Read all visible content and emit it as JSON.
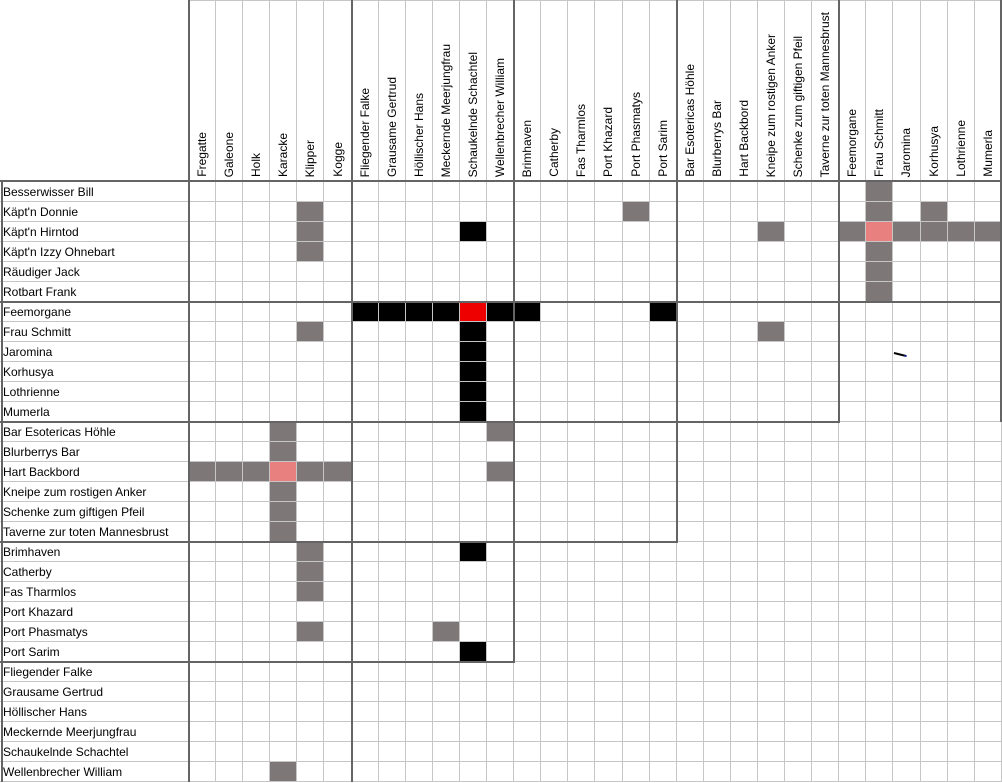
{
  "grid": {
    "row_labels": [
      "Besserwisser Bill",
      "Käpt'n Donnie",
      "Käpt'n Hirntod",
      "Käpt'n Izzy Ohnebart",
      "Räudiger Jack",
      "Rotbart Frank",
      "Feemorgane",
      "Frau Schmitt",
      "Jaromina",
      "Korhusya",
      "Lothrienne",
      "Mumerla",
      "Bar Esotericas Höhle",
      "Blurberrys Bar",
      "Hart Backbord",
      "Kneipe zum rostigen Anker",
      "Schenke zum giftigen Pfeil",
      "Taverne zur toten Mannesbrust",
      "Brimhaven",
      "Catherby",
      "Fas Tharmlos",
      "Port Khazard",
      "Port Phasmatys",
      "Port Sarim",
      "Fliegender Falke",
      "Grausame Gertrud",
      "Höllischer Hans",
      "Meckernde Meerjungfrau",
      "Schaukelnde Schachtel",
      "Wellenbrecher William"
    ],
    "col_labels": [
      "Fregatte",
      "Galeone",
      "Holk",
      "Karacke",
      "Klipper",
      "Kogge",
      "Fliegender Falke",
      "Grausame Gertrud",
      "Höllischer Hans",
      "Meckernde Meerjungfrau",
      "Schaukelnde Schachtel",
      "Wellenbrecher William",
      "Brimhaven",
      "Catherby",
      "Fas Tharmlos",
      "Port Khazard",
      "Port Phasmatys",
      "Port Sarim",
      "Bar Esotericas Höhle",
      "Blurberrys Bar",
      "Hart Backbord",
      "Kneipe zum rostigen Anker",
      "Schenke zum giftigen Pfeil",
      "Taverne zur toten Mannesbrust",
      "Feemorgane",
      "Frau Schmitt",
      "Jaromina",
      "Korhusya",
      "Lothrienne",
      "Mumerla"
    ],
    "marks": [
      {
        "r": 1,
        "c": 26,
        "state": "gray"
      },
      {
        "r": 2,
        "c": 5,
        "state": "gray"
      },
      {
        "r": 2,
        "c": 17,
        "state": "gray"
      },
      {
        "r": 2,
        "c": 26,
        "state": "gray"
      },
      {
        "r": 2,
        "c": 28,
        "state": "gray"
      },
      {
        "r": 3,
        "c": 5,
        "state": "gray"
      },
      {
        "r": 3,
        "c": 11,
        "state": "black"
      },
      {
        "r": 3,
        "c": 22,
        "state": "gray"
      },
      {
        "r": 3,
        "c": 25,
        "state": "gray"
      },
      {
        "r": 3,
        "c": 26,
        "state": "pink"
      },
      {
        "r": 3,
        "c": 27,
        "state": "gray"
      },
      {
        "r": 3,
        "c": 28,
        "state": "gray"
      },
      {
        "r": 3,
        "c": 29,
        "state": "gray"
      },
      {
        "r": 3,
        "c": 30,
        "state": "gray"
      },
      {
        "r": 4,
        "c": 5,
        "state": "gray"
      },
      {
        "r": 4,
        "c": 26,
        "state": "gray"
      },
      {
        "r": 5,
        "c": 26,
        "state": "gray"
      },
      {
        "r": 6,
        "c": 26,
        "state": "gray"
      },
      {
        "r": 7,
        "c": 7,
        "state": "black"
      },
      {
        "r": 7,
        "c": 8,
        "state": "black"
      },
      {
        "r": 7,
        "c": 9,
        "state": "black"
      },
      {
        "r": 7,
        "c": 10,
        "state": "black"
      },
      {
        "r": 7,
        "c": 11,
        "state": "red"
      },
      {
        "r": 7,
        "c": 12,
        "state": "black"
      },
      {
        "r": 7,
        "c": 13,
        "state": "black"
      },
      {
        "r": 7,
        "c": 18,
        "state": "black"
      },
      {
        "r": 8,
        "c": 5,
        "state": "gray"
      },
      {
        "r": 8,
        "c": 11,
        "state": "black"
      },
      {
        "r": 8,
        "c": 22,
        "state": "gray"
      },
      {
        "r": 9,
        "c": 11,
        "state": "black"
      },
      {
        "r": 9,
        "c": 27,
        "state": "slash"
      },
      {
        "r": 10,
        "c": 11,
        "state": "black"
      },
      {
        "r": 11,
        "c": 11,
        "state": "black"
      },
      {
        "r": 12,
        "c": 11,
        "state": "black"
      },
      {
        "r": 13,
        "c": 4,
        "state": "gray"
      },
      {
        "r": 13,
        "c": 12,
        "state": "gray"
      },
      {
        "r": 14,
        "c": 4,
        "state": "gray"
      },
      {
        "r": 15,
        "c": 1,
        "state": "gray"
      },
      {
        "r": 15,
        "c": 2,
        "state": "gray"
      },
      {
        "r": 15,
        "c": 3,
        "state": "gray"
      },
      {
        "r": 15,
        "c": 4,
        "state": "pink"
      },
      {
        "r": 15,
        "c": 5,
        "state": "gray"
      },
      {
        "r": 15,
        "c": 6,
        "state": "gray"
      },
      {
        "r": 15,
        "c": 12,
        "state": "gray"
      },
      {
        "r": 16,
        "c": 4,
        "state": "gray"
      },
      {
        "r": 17,
        "c": 4,
        "state": "gray"
      },
      {
        "r": 18,
        "c": 4,
        "state": "gray"
      },
      {
        "r": 19,
        "c": 5,
        "state": "gray"
      },
      {
        "r": 19,
        "c": 11,
        "state": "black"
      },
      {
        "r": 20,
        "c": 5,
        "state": "gray"
      },
      {
        "r": 21,
        "c": 5,
        "state": "gray"
      },
      {
        "r": 23,
        "c": 5,
        "state": "gray"
      },
      {
        "r": 23,
        "c": 10,
        "state": "gray"
      },
      {
        "r": 24,
        "c": 11,
        "state": "black"
      },
      {
        "r": 30,
        "c": 4,
        "state": "gray"
      }
    ],
    "colors": {
      "black": "#000000",
      "gray": "#7D7777",
      "red": "#EE0000",
      "pink": "#E88080",
      "grid_light": "#C6C6C6",
      "grid_dark": "#646464"
    }
  }
}
